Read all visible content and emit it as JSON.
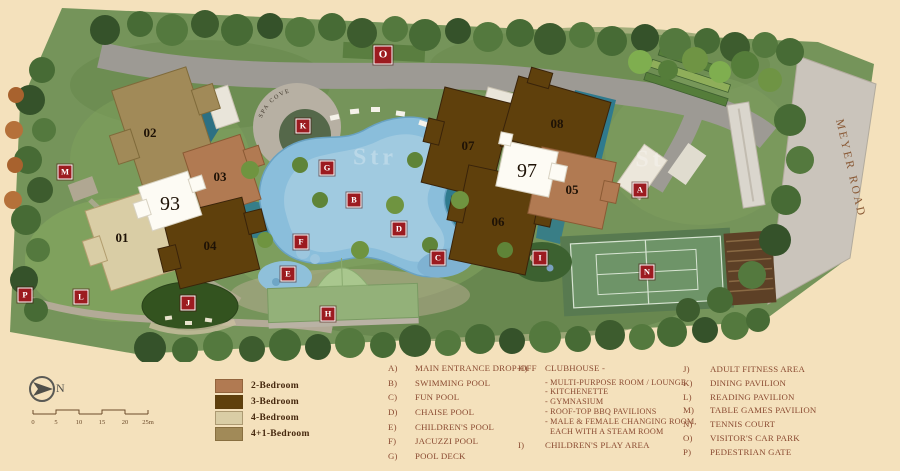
{
  "site_plan": {
    "road_label": "MEYER ROAD",
    "spa_deck_label": "SPA COVE",
    "watermarks": [
      "Str",
      "St"
    ],
    "block_numbers": {
      "left": "93",
      "right": "97"
    },
    "blocks": [
      {
        "id": "01",
        "type": "4-Bedroom",
        "color": "#d9cda5"
      },
      {
        "id": "02",
        "type": "4+1-Bedroom",
        "color": "#a18a58"
      },
      {
        "id": "03",
        "type": "2-Bedroom",
        "color": "#b17a52"
      },
      {
        "id": "04",
        "type": "3-Bedroom",
        "color": "#5f400c"
      },
      {
        "id": "05",
        "type": "2-Bedroom",
        "color": "#b17a52"
      },
      {
        "id": "06",
        "type": "3-Bedroom",
        "color": "#5f400c"
      },
      {
        "id": "07",
        "type": "3-Bedroom",
        "color": "#5f400c"
      },
      {
        "id": "08",
        "type": "3-Bedroom",
        "color": "#5f400c"
      }
    ],
    "markers": [
      {
        "letter": "A",
        "x": 640,
        "y": 190
      },
      {
        "letter": "B",
        "x": 354,
        "y": 200
      },
      {
        "letter": "C",
        "x": 438,
        "y": 258
      },
      {
        "letter": "D",
        "x": 399,
        "y": 229
      },
      {
        "letter": "E",
        "x": 288,
        "y": 274
      },
      {
        "letter": "F",
        "x": 301,
        "y": 242
      },
      {
        "letter": "G",
        "x": 327,
        "y": 168
      },
      {
        "letter": "H",
        "x": 328,
        "y": 314
      },
      {
        "letter": "I",
        "x": 540,
        "y": 258
      },
      {
        "letter": "J",
        "x": 188,
        "y": 303
      },
      {
        "letter": "K",
        "x": 303,
        "y": 126
      },
      {
        "letter": "L",
        "x": 81,
        "y": 297
      },
      {
        "letter": "M",
        "x": 65,
        "y": 172
      },
      {
        "letter": "N",
        "x": 647,
        "y": 272
      },
      {
        "letter": "O",
        "x": 383,
        "y": 55
      },
      {
        "letter": "P",
        "x": 25,
        "y": 295
      }
    ]
  },
  "legend": {
    "north_label": "N",
    "scale": {
      "ticks": [
        "0",
        "5",
        "10",
        "15",
        "20",
        "25m"
      ]
    },
    "unit_types": [
      {
        "label": "2-Bedroom",
        "color": "#b17a52"
      },
      {
        "label": "3-Bedroom",
        "color": "#5f400c"
      },
      {
        "label": "4-Bedroom",
        "color": "#d9cda5"
      },
      {
        "label": "4+1-Bedroom",
        "color": "#a18a58"
      }
    ]
  },
  "facilities": {
    "col1": [
      {
        "key": "A)",
        "label": "MAIN ENTRANCE DROP-OFF"
      },
      {
        "key": "B)",
        "label": "SWIMMING POOL"
      },
      {
        "key": "C)",
        "label": "FUN POOL"
      },
      {
        "key": "D)",
        "label": "CHAISE POOL"
      },
      {
        "key": "E)",
        "label": "CHILDREN'S POOL"
      },
      {
        "key": "F)",
        "label": "JACUZZI POOL"
      },
      {
        "key": "G)",
        "label": "POOL DECK"
      }
    ],
    "col2": {
      "key": "H)",
      "label": "CLUBHOUSE -",
      "sub": [
        "- MULTI-PURPOSE ROOM / LOUNGE",
        "- KITCHENETTE",
        "- GYMNASIUM",
        "- ROOF-TOP BBQ PAVILIONS",
        "- MALE & FEMALE CHANGING ROOM,",
        "EACH WITH A STEAM ROOM"
      ],
      "last": {
        "key": "I)",
        "label": "CHILDREN'S PLAY AREA"
      }
    },
    "col3": [
      {
        "key": "J)",
        "label": "ADULT FITNESS AREA"
      },
      {
        "key": "K)",
        "label": "DINING PAVILION"
      },
      {
        "key": "L)",
        "label": "READING PAVILION"
      },
      {
        "key": "M)",
        "label": "TABLE GAMES PAVILION"
      },
      {
        "key": "N)",
        "label": "TENNIS COURT"
      },
      {
        "key": "O)",
        "label": "VISITOR'S CAR PARK"
      },
      {
        "key": "P)",
        "label": "PEDESTRIAN GATE"
      }
    ]
  }
}
